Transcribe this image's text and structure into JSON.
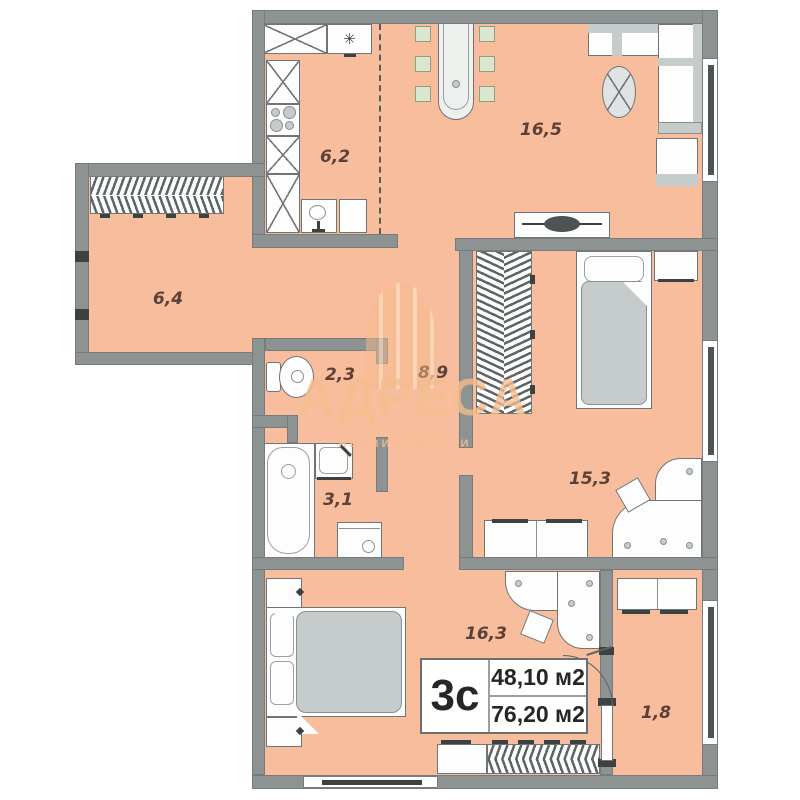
{
  "plan": {
    "unit_label": "3с",
    "living_area": "48,10 м2",
    "total_area": "76,20 м2"
  },
  "rooms": {
    "kitchen": {
      "area": "6,2"
    },
    "living_room": {
      "area": "16,5"
    },
    "hallway": {
      "area": "6,4"
    },
    "wc": {
      "area": "2,3"
    },
    "corridor": {
      "area": "8,9"
    },
    "bathroom": {
      "area": "3,1"
    },
    "bedroom_right": {
      "area": "15,3"
    },
    "bedroom_bottom": {
      "area": "16,3"
    },
    "balcony": {
      "area": "1,8"
    }
  },
  "icons": {
    "snowflake": "✳"
  },
  "watermark": {
    "title": "АДРЕСА",
    "subtitle": "АГЕНТСТВО НЕДВИЖИМОСТИ"
  },
  "colors": {
    "floor": "#f8bd9d",
    "wall": "#8d9292",
    "chair_green": "#dbe6d0",
    "blanket_gray": "#c6cbcb",
    "label_text": "#5d4037",
    "watermark_tint": "#f5c79a"
  }
}
